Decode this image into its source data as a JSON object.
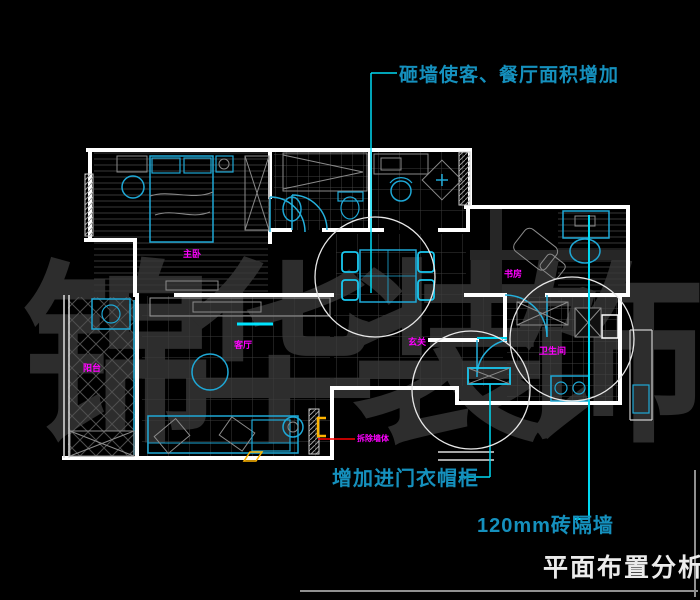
{
  "title_block": {
    "title": "平面布置分析",
    "frame_color": "#8f8f8f"
  },
  "annotations": {
    "top": {
      "text": "砸墙使客、餐厅面积增加",
      "color": "#1590bd"
    },
    "wardrobe": {
      "text": "增加进门衣帽柜",
      "color": "#1590bd"
    },
    "brick_wall": {
      "text": "120mm砖隔墙",
      "color": "#1590bd"
    },
    "wall_note": {
      "text": "拆除墙体",
      "color": "#ff00ff"
    }
  },
  "watermark": {
    "chars": [
      "锦",
      "华",
      "装",
      "饰"
    ],
    "color": "#2d2d2d"
  },
  "rooms": [
    {
      "id": "master-bedroom",
      "label": "主卧"
    },
    {
      "id": "living-room",
      "label": "客厅"
    },
    {
      "id": "balcony",
      "label": "阳台"
    },
    {
      "id": "hallway",
      "label": "玄关"
    },
    {
      "id": "study",
      "label": "书房"
    },
    {
      "id": "bathroom",
      "label": "卫生间"
    }
  ],
  "colors": {
    "background": "#000000",
    "walls": "#ffffff",
    "furniture": "#1ea8d6",
    "bright_cyan": "#00d9f2",
    "floor_lines": "#3a3a3a",
    "labels": "#ff00ff",
    "demolish_line": "#ff0000",
    "symbol_orange": "#ffb400"
  }
}
